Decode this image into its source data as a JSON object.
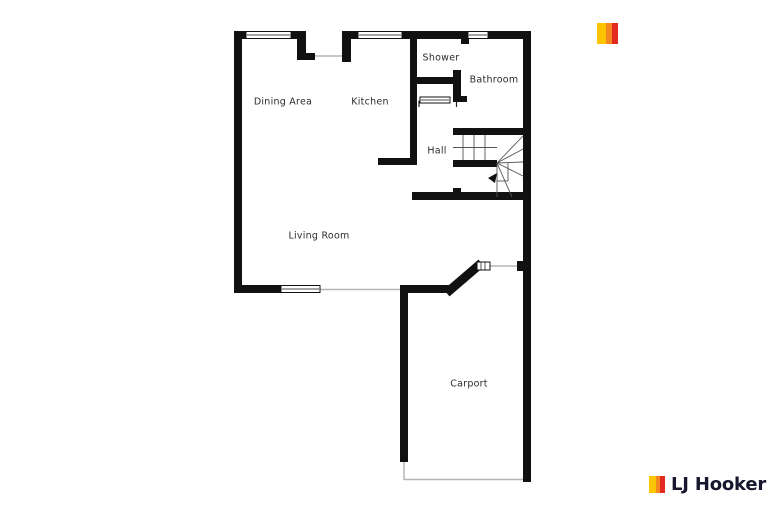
{
  "page": {
    "background": "#ffffff"
  },
  "floorplan": {
    "rooms": [
      {
        "id": "dining-area",
        "label": "Dining Area"
      },
      {
        "id": "kitchen",
        "label": "Kitchen"
      },
      {
        "id": "shower",
        "label": "Shower"
      },
      {
        "id": "bathroom",
        "label": "Bathroom"
      },
      {
        "id": "hall",
        "label": "Hall"
      },
      {
        "id": "living-room",
        "label": "Living Room"
      },
      {
        "id": "carport",
        "label": "Carport"
      }
    ],
    "wall_color": "#111111",
    "opening_line_color": "#b5b5b5",
    "stair_line_color": "#555555"
  },
  "branding": {
    "logo_text": "LJ Hooker",
    "colors": {
      "yellow": "#FDC500",
      "orange": "#F4871F",
      "red": "#E22A21",
      "text_dark": "#17172e",
      "text_light": "#ffffff"
    }
  }
}
